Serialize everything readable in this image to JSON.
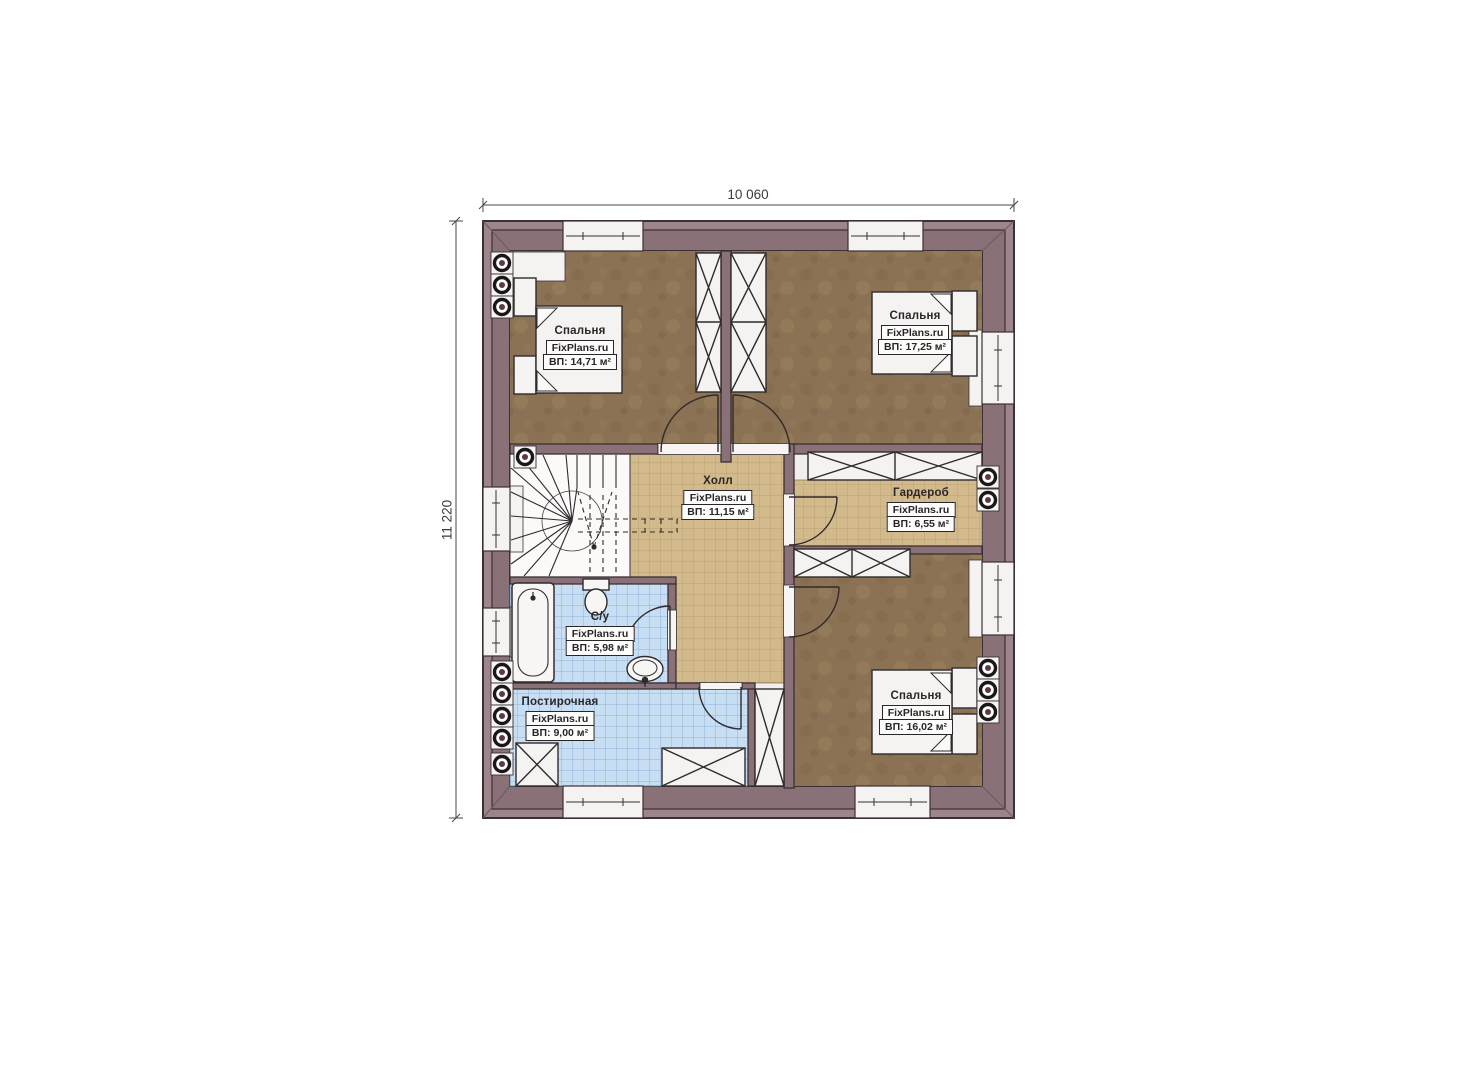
{
  "drawing": {
    "kind": "floor-plan",
    "dimensions": {
      "width": "10 060",
      "height": "11 220"
    }
  },
  "rooms": [
    {
      "id": "bedroom-top-left",
      "name": "Спальня",
      "brand": "FixPlans.ru",
      "area": "ВП: 14,71 м²"
    },
    {
      "id": "bedroom-top-right",
      "name": "Спальня",
      "brand": "FixPlans.ru",
      "area": "ВП: 17,25 м²"
    },
    {
      "id": "hall",
      "name": "Холл",
      "brand": "FixPlans.ru",
      "area": "ВП: 11,15 м²"
    },
    {
      "id": "wardrobe",
      "name": "Гардероб",
      "brand": "FixPlans.ru",
      "area": "ВП: 6,55 м²"
    },
    {
      "id": "bathroom",
      "name": "С/у",
      "brand": "FixPlans.ru",
      "area": "ВП: 5,98 м²"
    },
    {
      "id": "laundry",
      "name": "Постирочная",
      "brand": "FixPlans.ru",
      "area": "ВП: 9,00 м²"
    },
    {
      "id": "bedroom-bottom-right",
      "name": "Спальня",
      "brand": "FixPlans.ru",
      "area": "ВП: 16,02 м²"
    }
  ],
  "colors": {
    "wall": "#8a7077",
    "wall_trim": "#9d858b",
    "outline": "#3a3134",
    "floor_wood": "#8c7254",
    "tile_tan": "#d3ba8c",
    "tile_blue": "#c8def2",
    "fixture_white": "#f4f3f1"
  }
}
